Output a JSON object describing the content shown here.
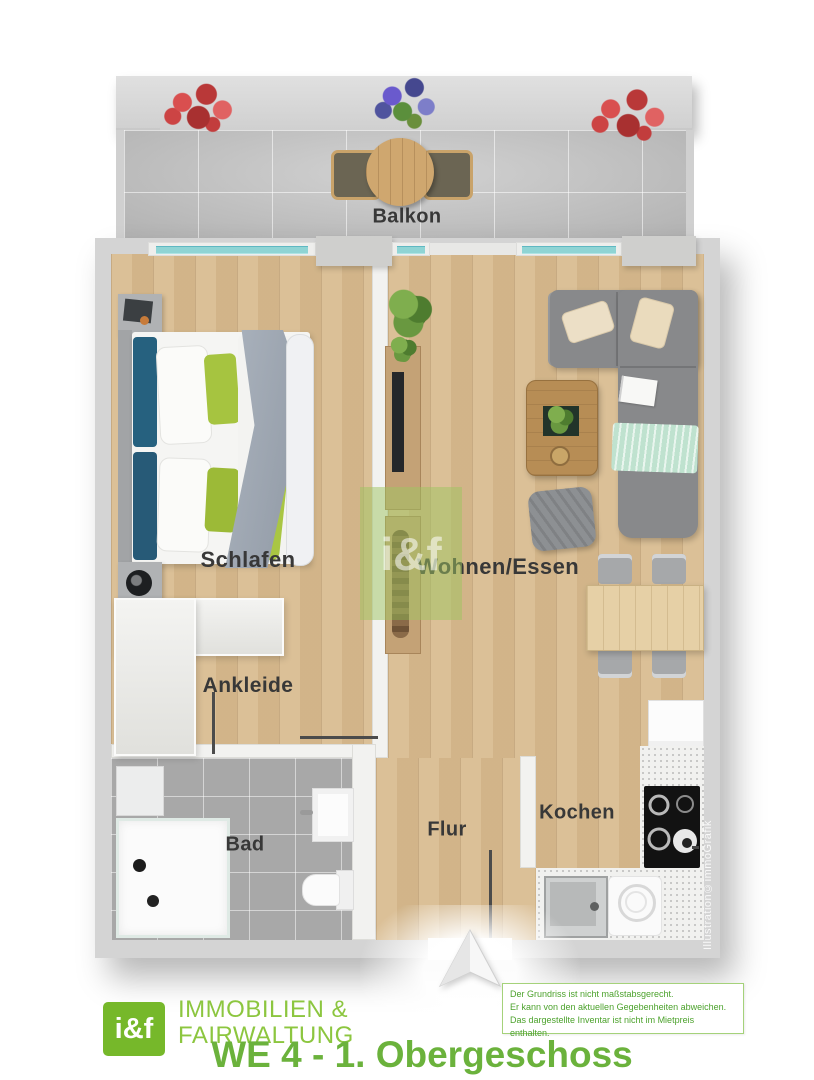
{
  "floorplan": {
    "rooms": {
      "balkon": "Balkon",
      "schlafen": "Schlafen",
      "wohnen_essen": "Wohnen/Essen",
      "ankleide": "Ankleide",
      "bad": "Bad",
      "flur": "Flur",
      "kochen": "Kochen"
    },
    "watermark": "i&f",
    "credit": "Illustration©immoGrafik"
  },
  "footer": {
    "logo": {
      "mark": "i&f",
      "name_line1": "IMMOBILIEN &",
      "name_line2": "FAIRWALTUNG"
    },
    "disclaimer": [
      "Der Grundriss ist nicht maßstabsgerecht.",
      "Er kann von den aktuellen Gegebenheiten abweichen.",
      "Das dargestellte Inventar ist nicht im Mietpreis enthalten."
    ],
    "title": "WE 4 - 1. Obergeschoss"
  },
  "colors": {
    "brand_green": "#76b82a",
    "title_green": "#6cb33d",
    "wood_floor": "#d8bb8f",
    "balcony_tile": "#c6c6c6",
    "bath_tile": "#a8a8a8",
    "wall_outer": "#d4d4d4",
    "wall_inner": "#f2f2f0",
    "window_glass": "#8fd4d4",
    "sofa_grey": "#88898b",
    "pillow_teal": "#26617f",
    "pillow_green": "#a6c440",
    "blanket_mint": "#bfe2cf"
  }
}
